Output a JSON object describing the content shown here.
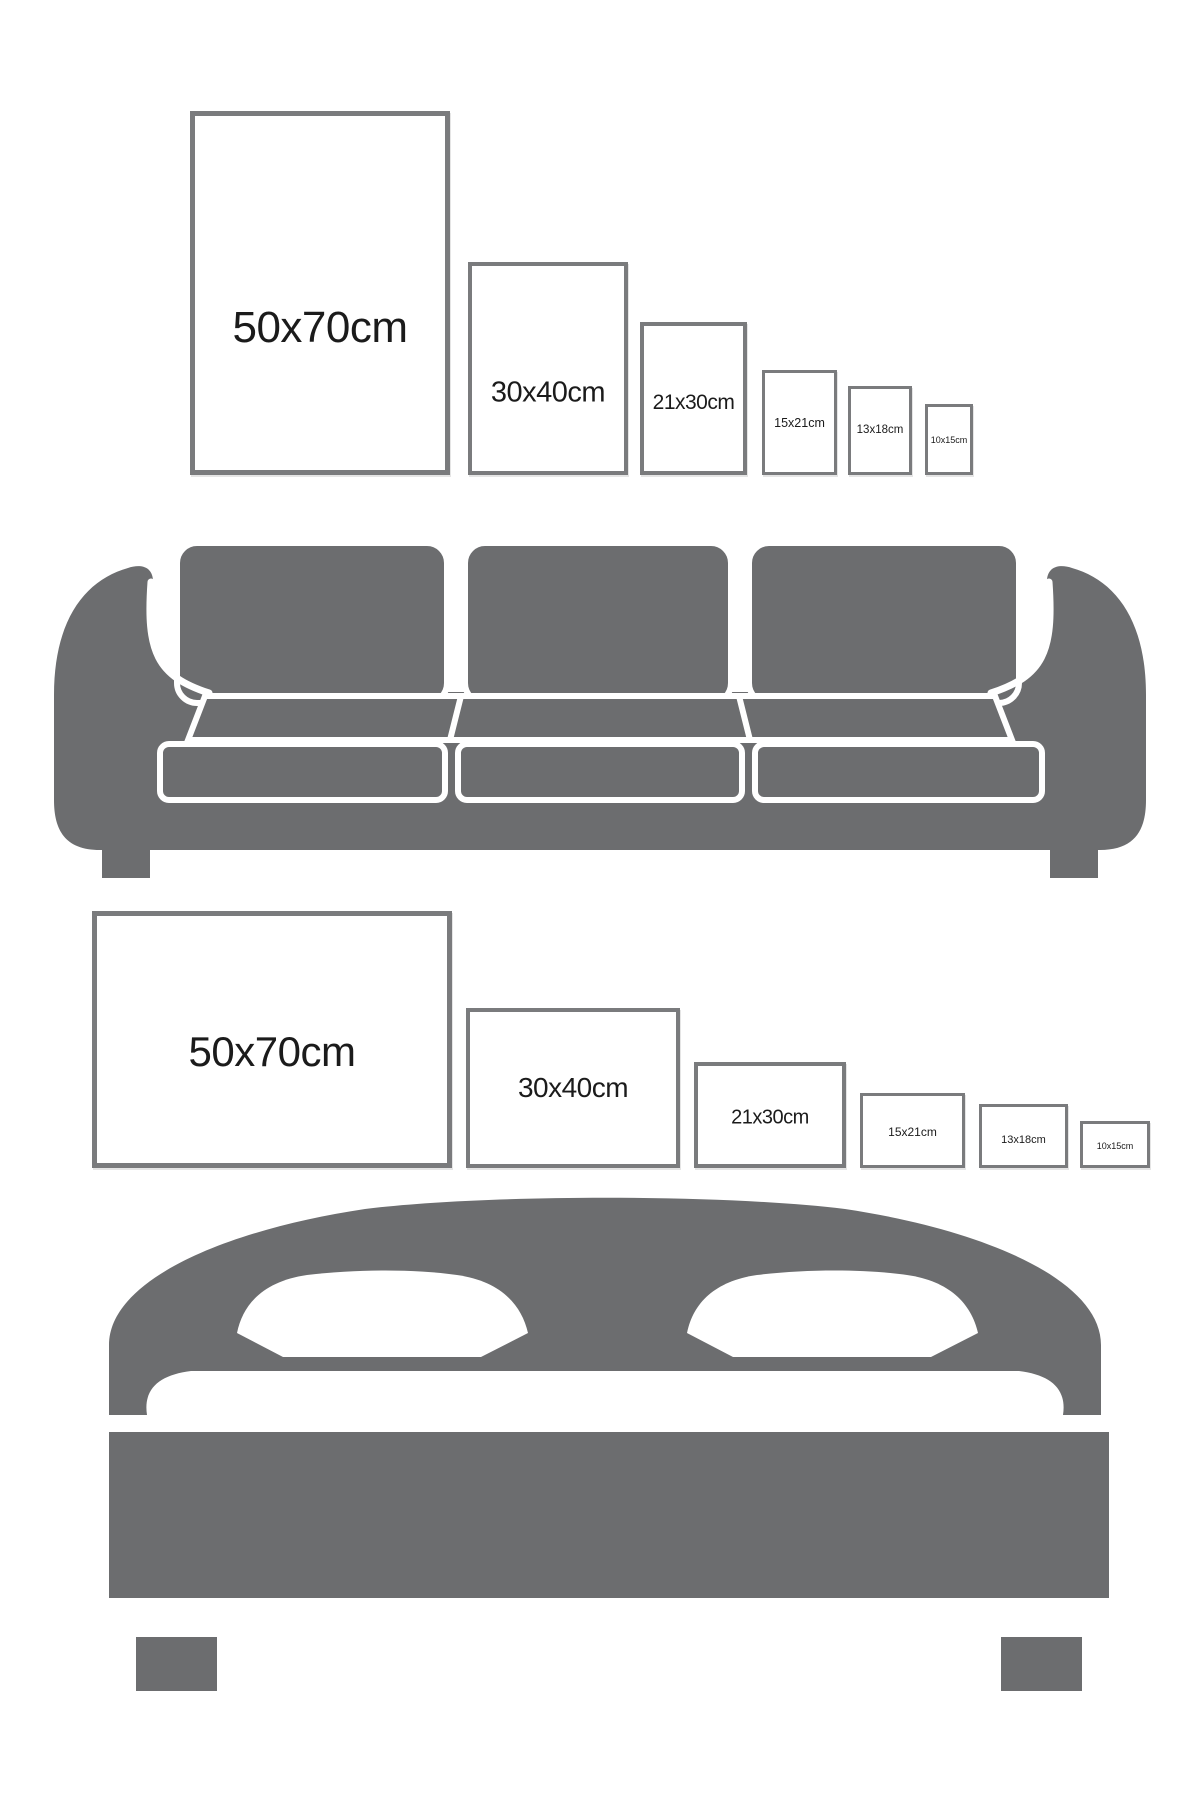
{
  "colors": {
    "background": "#ffffff",
    "furniture_gray": "#6c6d6f",
    "frame_border": "#7a7b7d",
    "label_text": "#1b1b1b"
  },
  "sofa_section": {
    "furniture_icon": "sofa-icon",
    "orientation": "portrait",
    "frames": [
      {
        "id": "50x70-portrait",
        "label": "50x70cm"
      },
      {
        "id": "30x40-portrait",
        "label": "30x40cm"
      },
      {
        "id": "21x30-portrait",
        "label": "21x30cm"
      },
      {
        "id": "15x21-portrait",
        "label": "15x21cm"
      },
      {
        "id": "13x18-portrait",
        "label": "13x18cm"
      },
      {
        "id": "10x15-portrait",
        "label": "10x15cm"
      }
    ]
  },
  "bed_section": {
    "furniture_icon": "bed-icon",
    "orientation": "landscape",
    "frames": [
      {
        "id": "50x70-landscape",
        "label": "50x70cm"
      },
      {
        "id": "30x40-landscape",
        "label": "30x40cm"
      },
      {
        "id": "21x30-landscape",
        "label": "21x30cm"
      },
      {
        "id": "15x21-landscape",
        "label": "15x21cm"
      },
      {
        "id": "13x18-landscape",
        "label": "13x18cm"
      },
      {
        "id": "10x15-landscape",
        "label": "10x15cm"
      }
    ]
  }
}
